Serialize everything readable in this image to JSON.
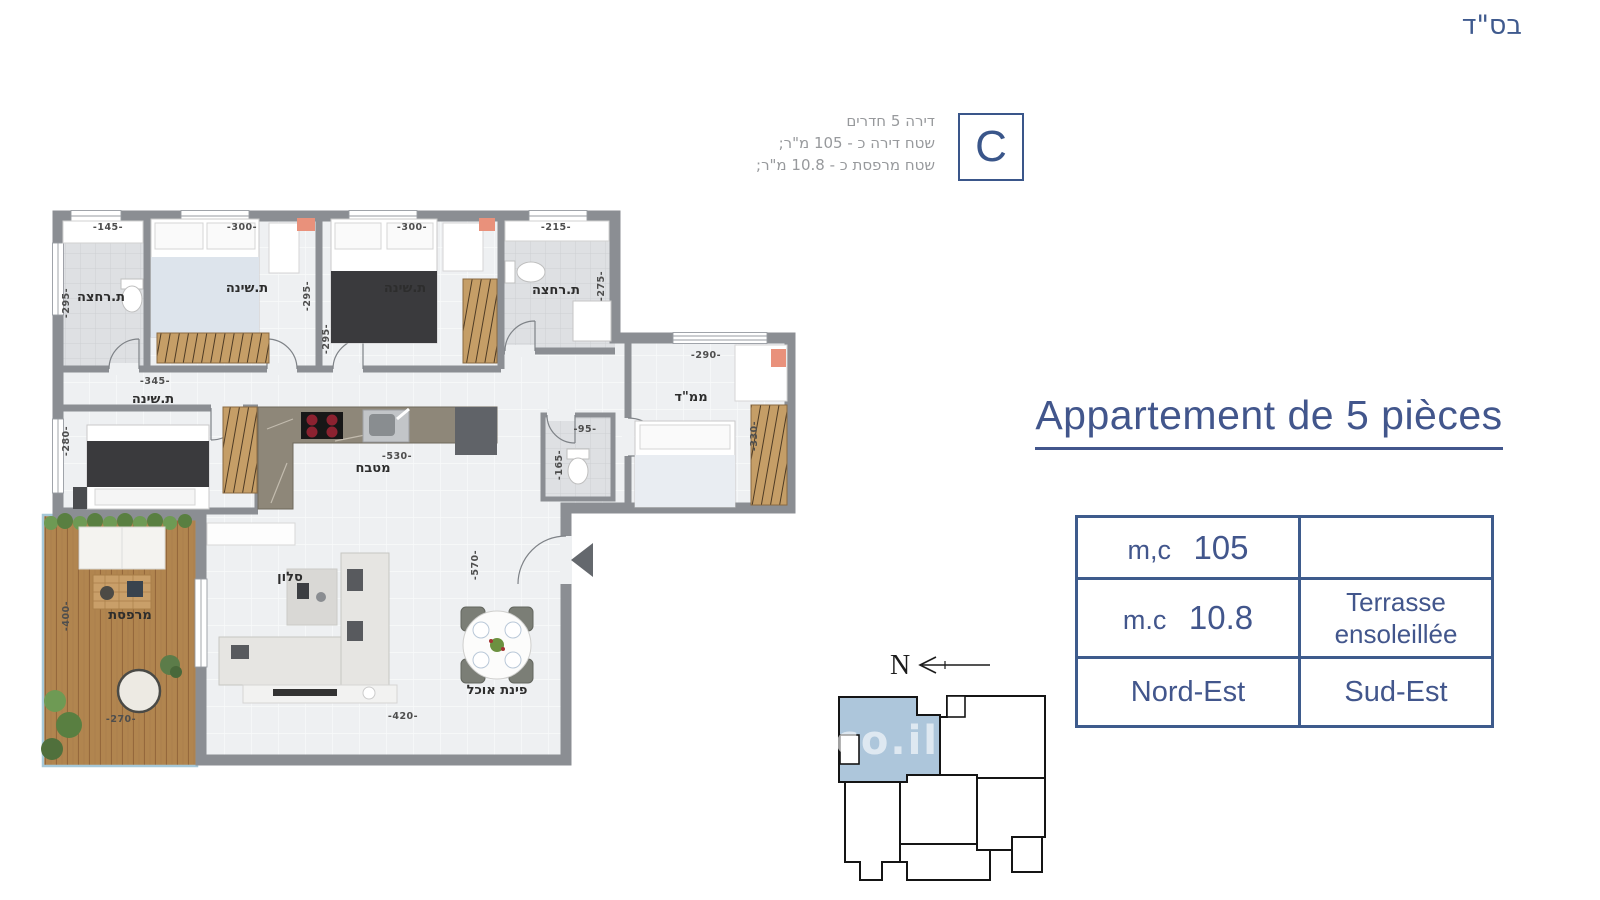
{
  "header": {
    "bsd": "בס\"ד"
  },
  "unit_info": {
    "line1": "דירה 5 חדרים",
    "line2": "שטח דירה כ - 105 מ\"ר;",
    "line3": "שטח מרפסת כ - 10.8 מ\"ר;",
    "letter": "C"
  },
  "title": {
    "text": "Appartement de 5 pièces"
  },
  "spec_table": {
    "r1c1_label": "m,c",
    "r1c1_value": "105",
    "r1c2": "",
    "r2c1_label": "m.c",
    "r2c1_value": "10.8",
    "r2c2_line1": "Terrasse",
    "r2c2_line2": "ensoleillée",
    "r3c1": "Nord-Est",
    "r3c2": "Sud-Est"
  },
  "key_plan": {
    "north": "N",
    "watermark": ".co.il",
    "highlight_color": "#adc6db"
  },
  "plan": {
    "rooms": {
      "bath1": "ת.רחצה",
      "bed1": "ת.שינה",
      "bed2": "ת.שינה",
      "bath2": "ת.רחצה",
      "mamad": "ממ\"ד",
      "bed3": "ת.שינה",
      "kitchen": "מטבח",
      "living": "סלון",
      "dining": "פינת אוכל",
      "terrace": "מרפסת"
    },
    "dims": {
      "bath1_w": "-145-",
      "bed1_w": "-300-",
      "bed2_w": "-300-",
      "bath2_w": "-215-",
      "bath1_h": "-295-",
      "bed1_h": "-295-",
      "bed2_h": "-295-",
      "bath2_h": "-275-",
      "mamad_w": "-290-",
      "mamad_h": "-330-",
      "bed3_w": "-345-",
      "bed3_h": "-280-",
      "kitchen_w": "-530-",
      "wc_w": "-95-",
      "wc_h": "-165-",
      "living_h": "-570-",
      "living_w": "-420-",
      "terrace_h": "-400-",
      "terrace_w": "-270-"
    },
    "colors": {
      "wall": "#8b8e93",
      "accent": "#42568c",
      "wood": "#c59e67",
      "deck": "#b1854f"
    }
  }
}
